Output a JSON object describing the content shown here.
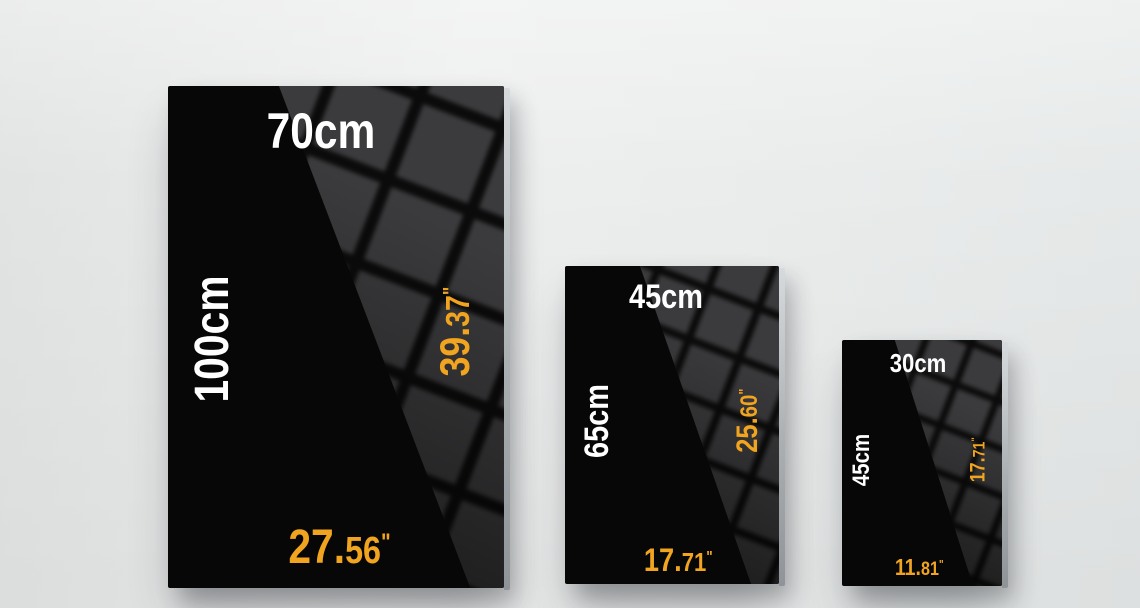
{
  "scene": {
    "background_color": "#eaecec",
    "accent_color": "#F1A41F",
    "panel_color": "#070707",
    "reflection_tile_color": "#3b3b3d",
    "text_color": "#ffffff"
  },
  "panels": [
    {
      "name": "large",
      "size_cm": "70x100cm",
      "top_label": "70cm",
      "side_label": "100cm",
      "side_inches": {
        "whole": "39.",
        "frac": "37",
        "unit": "\""
      },
      "bottom_inches": {
        "whole": "27.",
        "frac": "56",
        "unit": "\""
      }
    },
    {
      "name": "medium",
      "size_cm": "45x65cm",
      "top_label": "45cm",
      "side_label": "65cm",
      "side_inches": {
        "whole": "25.",
        "frac": "60",
        "unit": "\""
      },
      "bottom_inches": {
        "whole": "17.",
        "frac": "71",
        "unit": "\""
      }
    },
    {
      "name": "small",
      "size_cm": "30x45cm",
      "top_label": "30cm",
      "side_label": "45cm",
      "side_inches": {
        "whole": "17.",
        "frac": "71",
        "unit": "\""
      },
      "bottom_inches": {
        "whole": "11.",
        "frac": "81",
        "unit": "\""
      }
    }
  ]
}
